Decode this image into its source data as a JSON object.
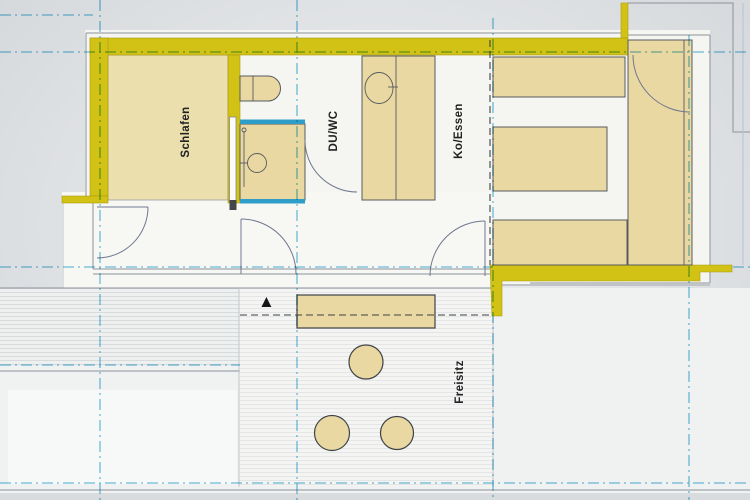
{
  "plan": {
    "rooms": [
      {
        "id": "schlafen",
        "label": "Schlafen"
      },
      {
        "id": "duwc",
        "label": "DU/WC"
      },
      {
        "id": "koessen",
        "label": "Ko/Essen"
      },
      {
        "id": "freisitz",
        "label": "Freisitz"
      }
    ],
    "north_arrow_glyph": "▲"
  },
  "colors": {
    "background": "#e9ebed",
    "paper": "#f5f6f2",
    "wall": "#d3c216",
    "floor": "#ecdfae",
    "furniture": "#e9d8a2",
    "shower_edge": "#2e9ec9",
    "grid": "#5fb9de",
    "outline": "#575b60",
    "light_line": "#8d929a",
    "dash_black": "#3f4246",
    "label": "#222222"
  }
}
